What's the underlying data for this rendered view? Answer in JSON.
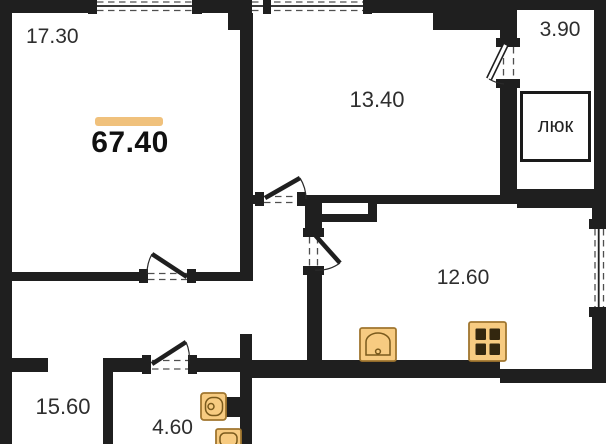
{
  "plan": {
    "total_area": {
      "value": "67.40"
    },
    "rooms": {
      "living": "17.30",
      "bedroom": "13.40",
      "entry": "3.90",
      "kitchen": "12.60",
      "hall": "15.60",
      "bath": "4.60"
    },
    "hatch_label": "люк",
    "colors": {
      "wall": "#1F1F1F",
      "accent": "#F0C17C",
      "fixture_fill": "#F7CB81",
      "fixture_border": "#A0762F"
    },
    "fixtures": [
      "toilet-icon",
      "washbasin-icon",
      "sink-icon",
      "stove-icon"
    ]
  }
}
